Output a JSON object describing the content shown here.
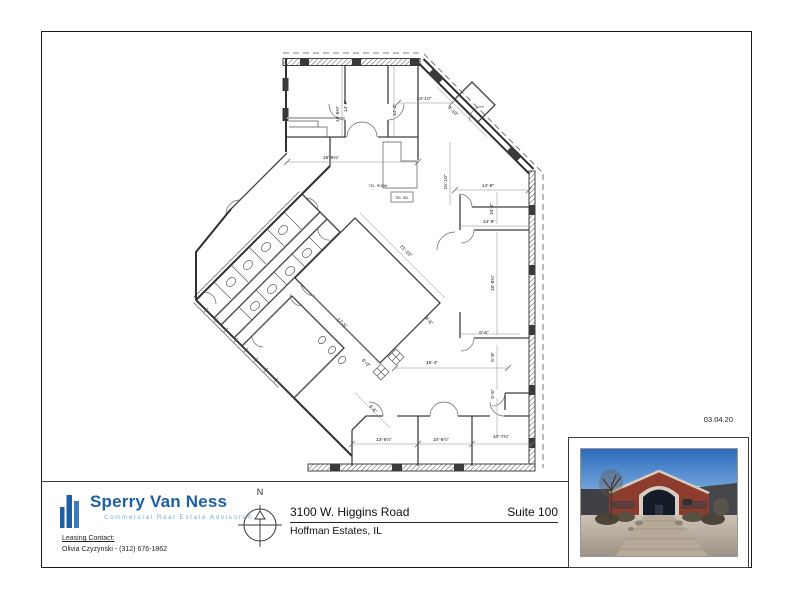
{
  "page": {
    "date": "03.04.20"
  },
  "colors": {
    "brand": "#1d5fa7",
    "tagline": "#79a9cc",
    "frame": "#1a1a1a"
  },
  "title_block": {
    "logo": {
      "name": "Sperry Van Ness",
      "tagline": "Commercial Real Estate Advisors®"
    },
    "leasing_contact_label": "Leasing Contact:",
    "leasing_contact": "Olivia Czyzynski - (312) 676-1862",
    "compass_label": "N",
    "address_line1": "3100 W. Higgins Road",
    "suite": "Suite 100",
    "address_line2": "Hoffman Estates, IL"
  },
  "floor_plan": {
    "texts": [
      {
        "t": "14'-5⅜\"",
        "x": 339,
        "y": 114,
        "r": -90
      },
      {
        "t": "14'-0\"",
        "x": 347,
        "y": 106,
        "r": -90
      },
      {
        "t": "14'-0\"",
        "x": 396,
        "y": 110,
        "r": -90
      },
      {
        "t": "13'-10\"",
        "x": 424,
        "y": 100,
        "r": 0
      },
      {
        "t": "18'-8¾\"",
        "x": 331,
        "y": 159,
        "r": 0
      },
      {
        "t": "9'-10\"",
        "x": 452,
        "y": 112,
        "r": 45
      },
      {
        "t": "15'-10\"",
        "x": 447,
        "y": 182,
        "r": -90
      },
      {
        "t": "14'-8\"",
        "x": 488,
        "y": 187,
        "r": 0
      },
      {
        "t": "14'-9\"",
        "x": 489,
        "y": 223,
        "r": 0
      },
      {
        "t": "10'-2\"",
        "x": 493,
        "y": 209,
        "r": -90
      },
      {
        "t": "15'-8¾\"",
        "x": 494,
        "y": 283,
        "r": -90
      },
      {
        "t": "6'-6\"",
        "x": 484,
        "y": 334,
        "r": 0
      },
      {
        "t": "21'-10\"",
        "x": 405,
        "y": 252,
        "r": 45
      },
      {
        "t": "17'-5\"",
        "x": 341,
        "y": 324,
        "r": 45
      },
      {
        "t": "6'-0\"",
        "x": 365,
        "y": 364,
        "r": 45
      },
      {
        "t": "4'-6\"",
        "x": 428,
        "y": 322,
        "r": 45
      },
      {
        "t": "4'-6\"",
        "x": 372,
        "y": 410,
        "r": 45
      },
      {
        "t": "15'-4\"",
        "x": 432,
        "y": 364,
        "r": 0
      },
      {
        "t": "13'-6½\"",
        "x": 384,
        "y": 441,
        "r": 0
      },
      {
        "t": "10'-8½\"",
        "x": 441,
        "y": 441,
        "r": 0
      },
      {
        "t": "10'-7¾\"",
        "x": 501,
        "y": 438,
        "r": 0
      },
      {
        "t": "5'-8\"",
        "x": 494,
        "y": 357,
        "r": -90
      },
      {
        "t": "5'-6\"",
        "x": 494,
        "y": 394,
        "r": -90
      },
      {
        "t": "TEL. ROOM",
        "x": 378,
        "y": 187,
        "r": 0,
        "cls": "roomt",
        "n": "room-label"
      },
      {
        "t": "TEL. BD.",
        "x": 402,
        "y": 199,
        "r": 0,
        "cls": "roomt",
        "n": "room-label"
      }
    ]
  }
}
